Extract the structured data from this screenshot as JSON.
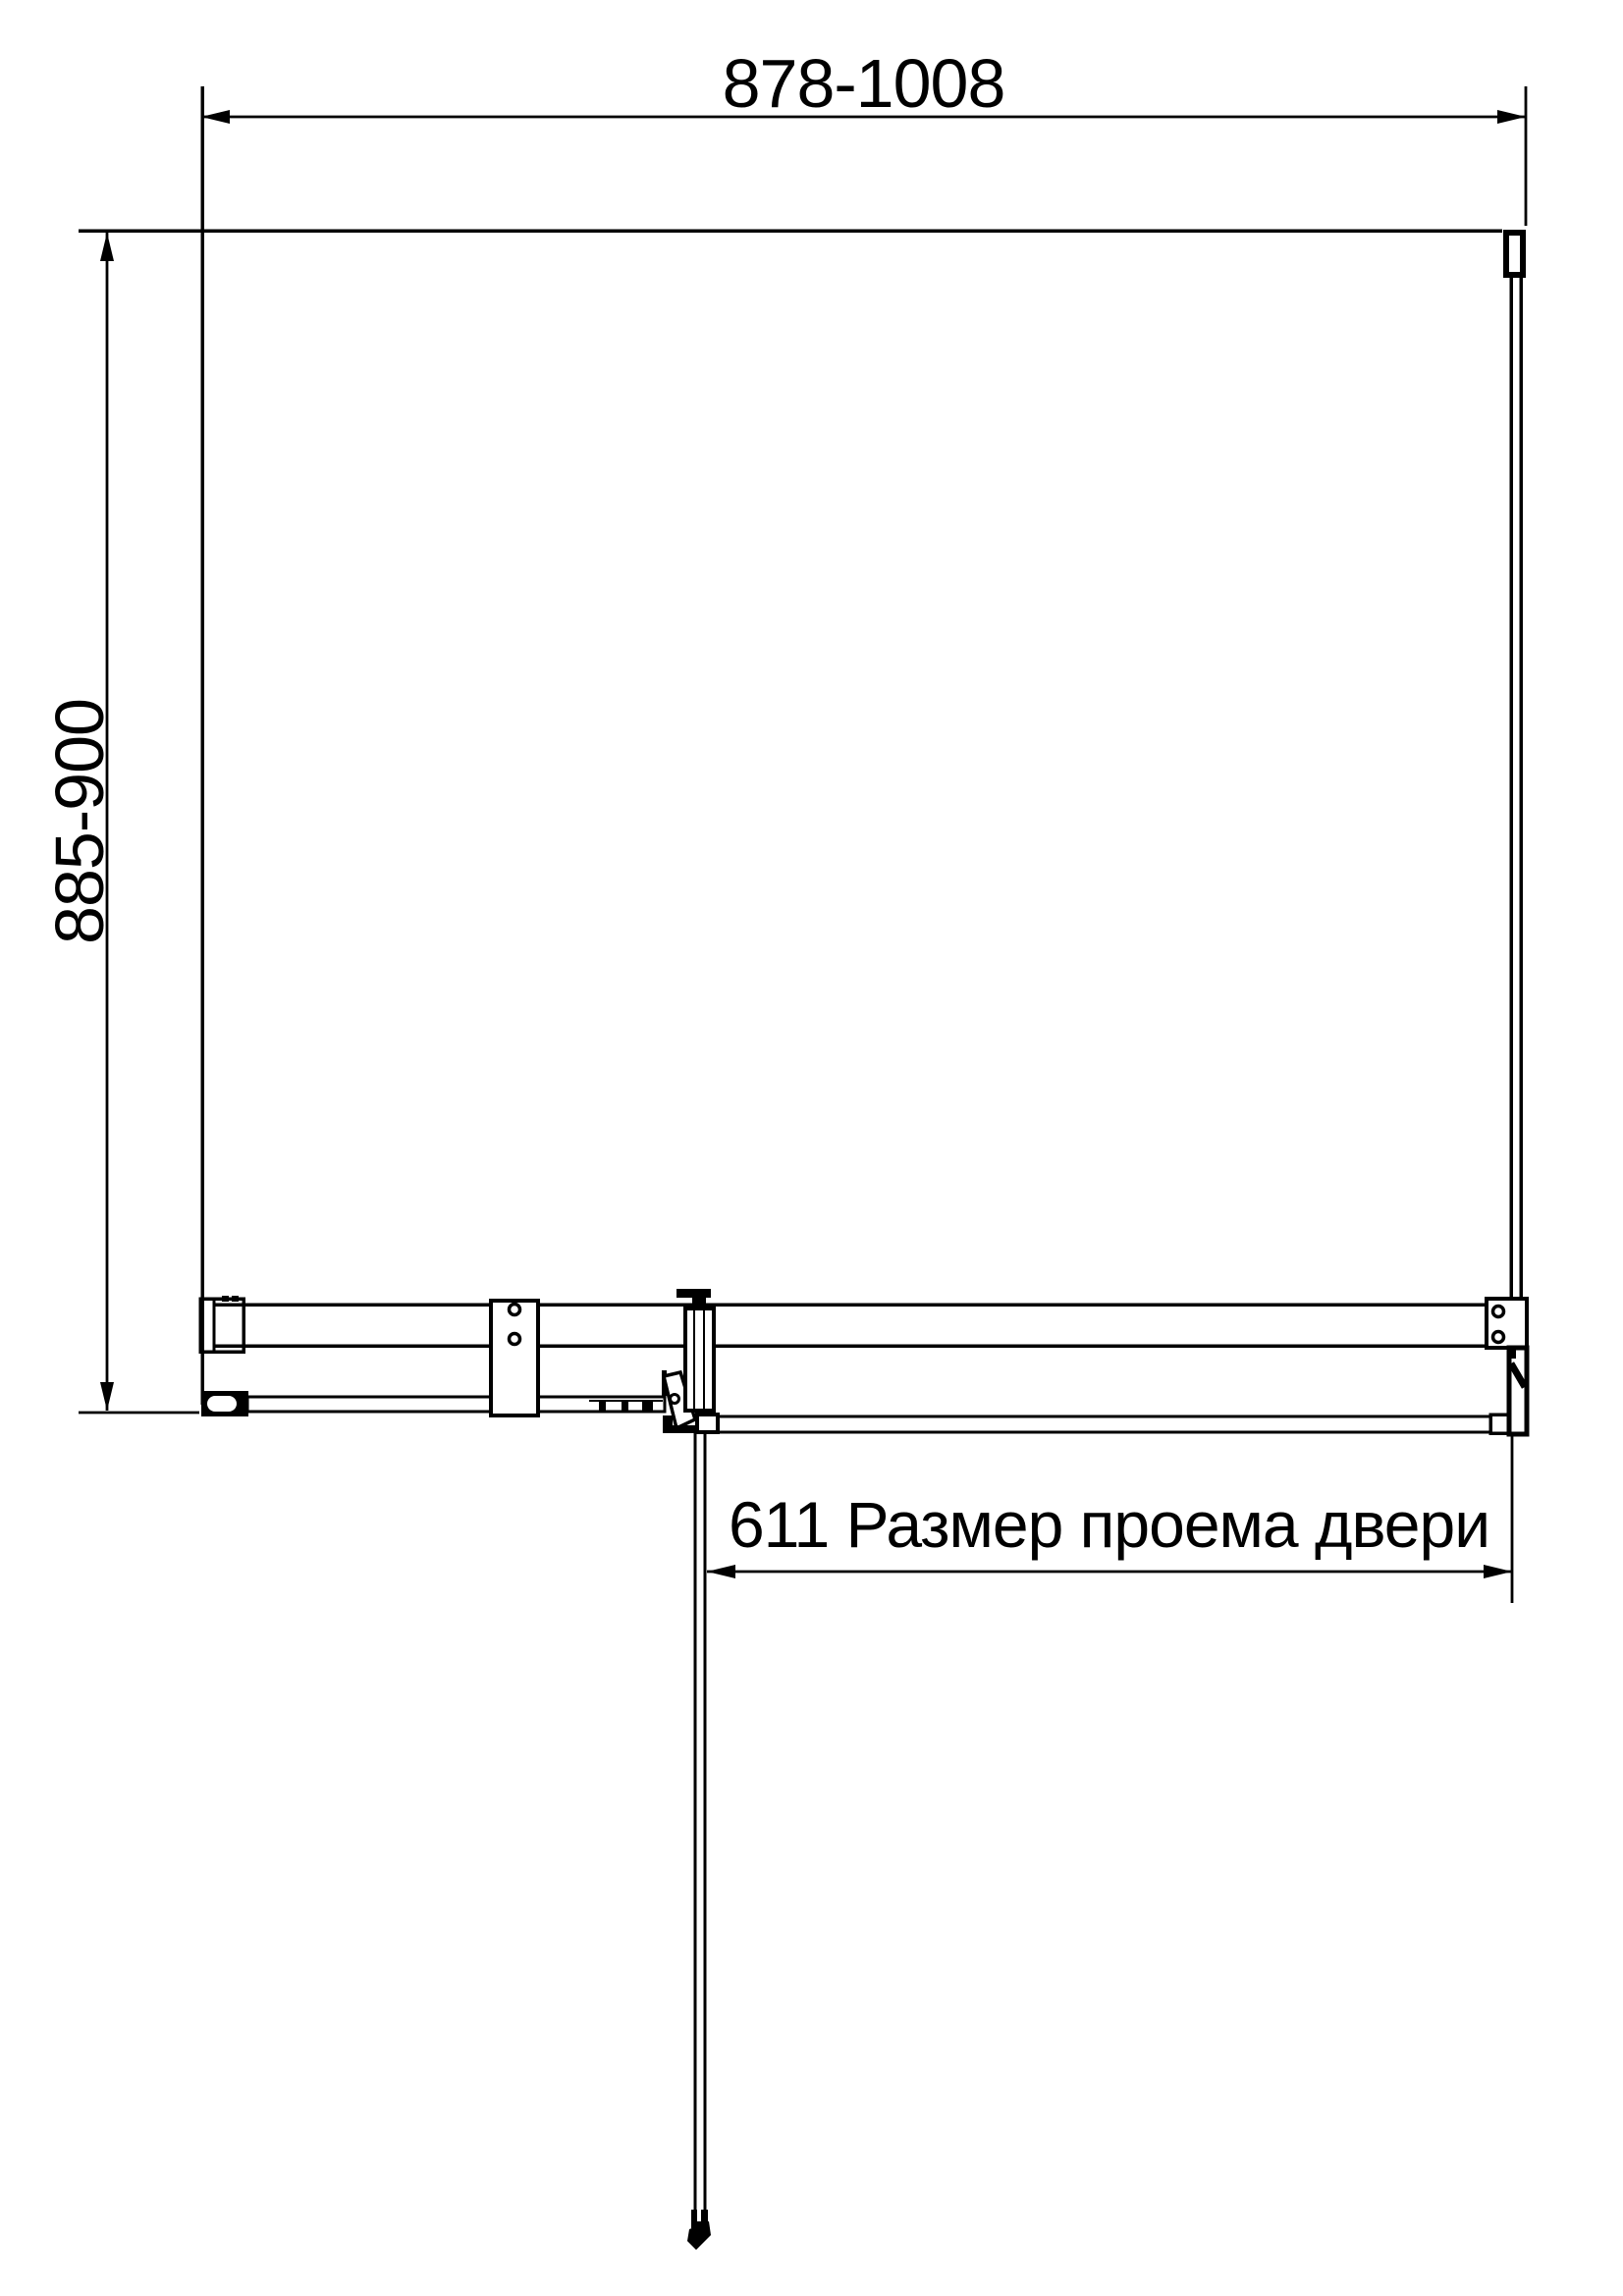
{
  "colors": {
    "background": "#ffffff",
    "line": "#000000"
  },
  "dimensions": {
    "overall_width_label": "878-1008",
    "overall_depth_label": "885-900",
    "door_opening_label": "611 Размер проема двери"
  }
}
